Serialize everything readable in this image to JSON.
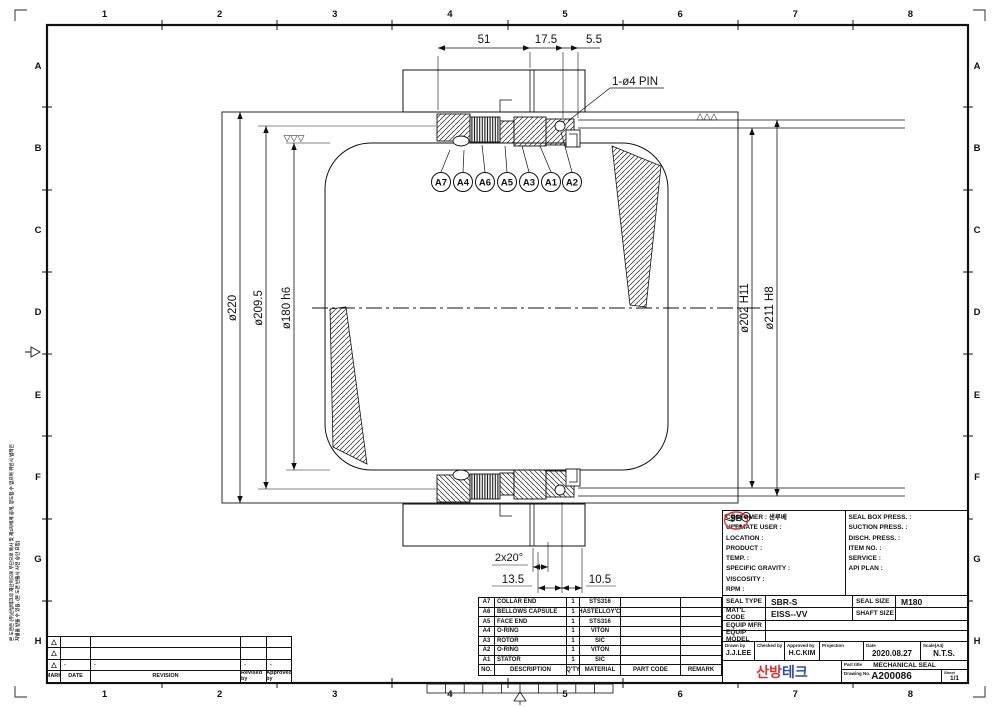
{
  "sheet": {
    "grid_numbers": [
      "1",
      "2",
      "3",
      "4",
      "5",
      "6",
      "7",
      "8"
    ],
    "grid_letters": [
      "A",
      "B",
      "C",
      "D",
      "E",
      "F",
      "G",
      "H"
    ],
    "side_note": "본 도면은 (주)산방테크의 재산이므로 무단으로 복사 및 제3자에게 공개, 양도할 수 없으며 위반시 법적인 처벌을 받을 수 있음. (본 도면 반출시 사전 승인 요함)"
  },
  "drawing": {
    "dim_51": "51",
    "dim_17_5": "17.5",
    "dim_5_5": "5.5",
    "pin_label": "1-ø4 PIN",
    "dim_220": "ø220",
    "dim_209_5": "ø209.5",
    "dim_180": "ø180 h6",
    "dim_202": "ø202 H11",
    "dim_211": "ø211 H8",
    "dim_chamfer": "2x20°",
    "dim_13_5": "13.5",
    "dim_10_5": "10.5",
    "balloons": [
      "A7",
      "A4",
      "A6",
      "A5",
      "A3",
      "A1",
      "A2"
    ],
    "finish_left": "▽▽▽",
    "finish_right": "△△△"
  },
  "parts_table": {
    "headers": {
      "no": "NO.",
      "description": "DESCRIPTION",
      "qty": "Q'TY",
      "material": "MATERIAL",
      "part_code": "PART CODE",
      "remark": "REMARK"
    },
    "rows": [
      {
        "no": "A7",
        "description": "COLLAR END",
        "qty": "1",
        "material": "STS316",
        "part_code": "",
        "remark": ""
      },
      {
        "no": "A6",
        "description": "BELLOWS CAPSULE",
        "qty": "1",
        "material": "HASTELLOY'C'",
        "part_code": "",
        "remark": ""
      },
      {
        "no": "A5",
        "description": "FACE END",
        "qty": "1",
        "material": "STS316",
        "part_code": "",
        "remark": ""
      },
      {
        "no": "A4",
        "description": "O-RING",
        "qty": "1",
        "material": "VITON",
        "part_code": "",
        "remark": ""
      },
      {
        "no": "A3",
        "description": "ROTOR",
        "qty": "1",
        "material": "SIC",
        "part_code": "",
        "remark": ""
      },
      {
        "no": "A2",
        "description": "O-RING",
        "qty": "1",
        "material": "VITON",
        "part_code": "",
        "remark": ""
      },
      {
        "no": "A1",
        "description": "STATOR",
        "qty": "1",
        "material": "SIC",
        "part_code": "",
        "remark": ""
      }
    ]
  },
  "title_block": {
    "left_fields": [
      "CUSTOMER : 샌루베",
      "ULTIMATE USER :",
      "LOCATION :",
      "PRODUCT :",
      "TEMP. :",
      "SPECIFIC GRAVITY :",
      "VISCOSITY :",
      "RPM :"
    ],
    "right_fields": [
      "SEAL BOX PRESS. :",
      "SUCTION PRESS. :",
      "DISCH. PRESS. :",
      "ITEM NO. :",
      "SERVICE :",
      "API PLAN :"
    ],
    "seal_type_label": "SEAL TYPE",
    "seal_type_value": "SBR-S",
    "seal_size_label": "SEAL SIZE",
    "seal_size_value": "M180",
    "matl_code_label": "MAT'L CODE",
    "matl_code_value": "EISS--VV",
    "shaft_size_label": "SHAFT SIZE",
    "shaft_size_value": "",
    "equip_mfr_label": "EQUIP MFR",
    "equip_mfr_value": "",
    "equip_model_label": "EQUIP MODEL",
    "equip_model_value": "",
    "drawn_by_label": "Drawn by",
    "drawn_by_value": "J.J.LEE",
    "checked_by_label": "Checked by",
    "checked_by_value": "",
    "approved_by_label": "Approved by",
    "approved_by_value": "H.C.KIM",
    "projection_label": "Projection",
    "date_label": "Date",
    "date_value": "2020.08.27",
    "scale_label": "Scale(A4)",
    "scale_value": "N.T.S.",
    "part_title_label": "Part title",
    "part_title_value": "MECHANICAL SEAL",
    "drawing_no_label": "Drawing No.",
    "drawing_no_value": "A200086",
    "sheet_label": "Sheet",
    "sheet_value": "1/1"
  },
  "logo": {
    "sb": "SB",
    "tech": "TECH",
    "name_red": "산방",
    "name_blue": "테크",
    "red": "#d63431",
    "blue": "#2e4ea4"
  },
  "revision_table": {
    "headers": {
      "mark": "MARK",
      "date": "DATE",
      "revision": "REVISION",
      "revised_by": "Revised by",
      "approved_by": "Approved by"
    },
    "rows": [
      {
        "mark": "△",
        "date": "",
        "revision": "",
        "revised_by": "",
        "approved_by": ""
      },
      {
        "mark": "△",
        "date": "",
        "revision": "",
        "revised_by": "",
        "approved_by": ""
      },
      {
        "mark": "△",
        "date": "-",
        "revision": "-",
        "revised_by": "-",
        "approved_by": "-"
      }
    ]
  }
}
